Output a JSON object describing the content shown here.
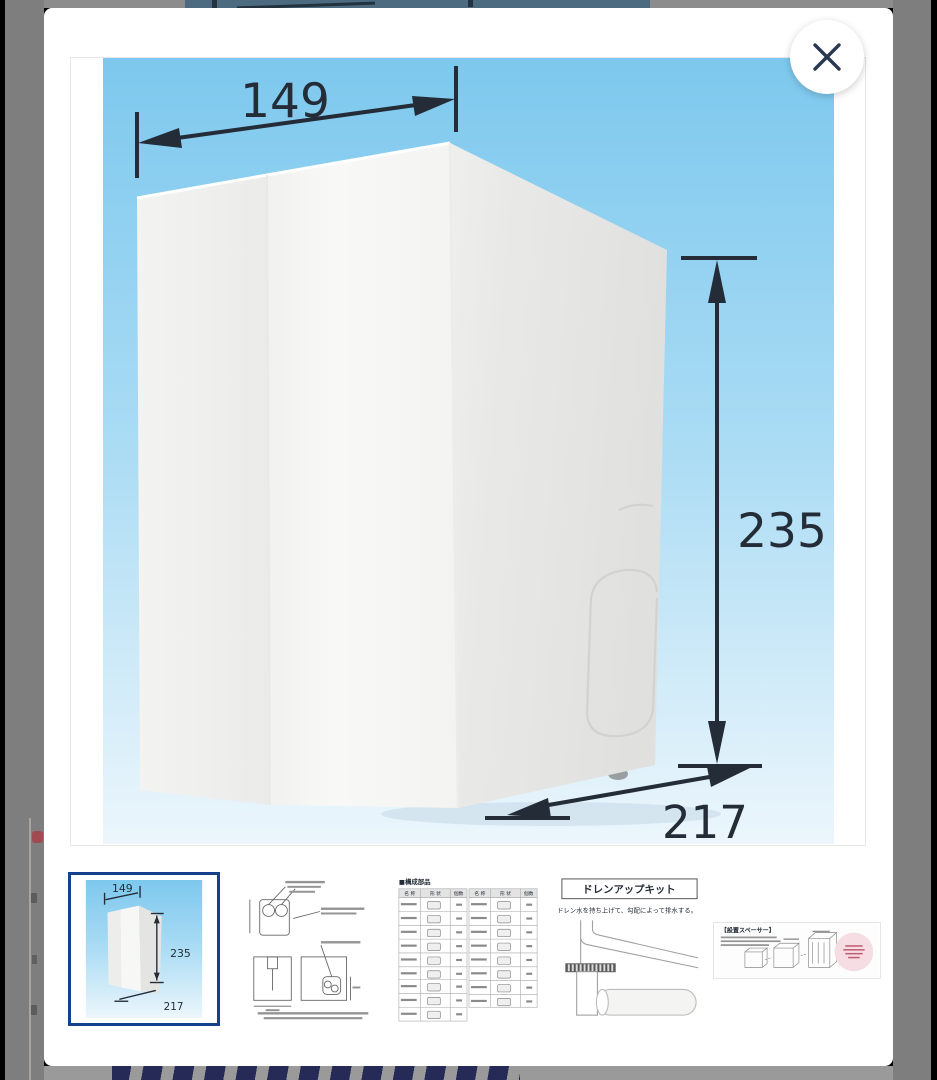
{
  "lightbox": {
    "close_button": {
      "icon": "x-mark"
    }
  },
  "product_image": {
    "width_label": "149",
    "height_label": "235",
    "depth_label": "217"
  },
  "thumbnails": {
    "item1": {
      "selected": true,
      "width_label": "149",
      "height_label": "235",
      "depth_label": "217"
    },
    "item2": {
      "selected": false
    },
    "item3": {
      "selected": false,
      "header": "■構成部品",
      "col_name": "名 称",
      "col_shape": "形 状",
      "col_qty": "個数"
    },
    "item4": {
      "selected": false,
      "title": "ドレンアップキット",
      "caption": "ドレン水を持ち上げて、勾配によって排水する。"
    },
    "item5": {
      "selected": false,
      "title": "【設置スペーサー】"
    }
  },
  "colors": {
    "selected_thumbnail_border": "#15418e",
    "dimension_ink": "#242c38",
    "sky_top": "#7dc8ee",
    "sky_bottom": "#ecf6fc",
    "backdrop_gray": "#7e7e7e",
    "bottom_letters_navy": "#252b56"
  }
}
